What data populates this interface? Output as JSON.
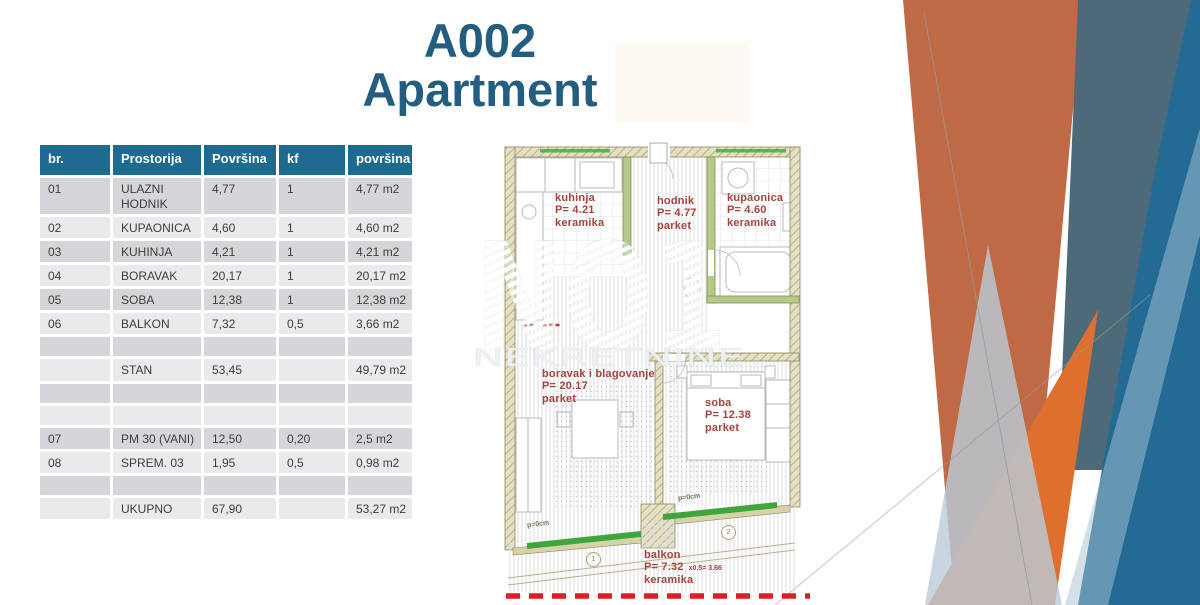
{
  "title": {
    "line1": "A002",
    "line2": "Apartment"
  },
  "table": {
    "headers": [
      "br.",
      "Prostorija",
      "Površina",
      "kf",
      "površina"
    ],
    "rows": [
      {
        "cells": [
          "01",
          "ULAZNI HODNIK",
          "4,77",
          "1",
          "4,77 m2"
        ]
      },
      {
        "cells": [
          "02",
          "KUPAONICA",
          "4,60",
          "1",
          "4,60 m2"
        ]
      },
      {
        "cells": [
          "03",
          "KUHINJA",
          "4,21",
          "1",
          "4,21 m2"
        ]
      },
      {
        "cells": [
          "04",
          "BORAVAK",
          "20,17",
          "1",
          "20,17 m2"
        ]
      },
      {
        "cells": [
          "05",
          "SOBA",
          "12,38",
          "1",
          "12,38 m2"
        ]
      },
      {
        "cells": [
          "06",
          "BALKON",
          "7,32",
          "0,5",
          "3,66 m2"
        ]
      },
      {
        "cells": [
          "",
          "",
          "",
          "",
          ""
        ]
      },
      {
        "cells": [
          "",
          "STAN",
          "53,45",
          "",
          "49,79 m2"
        ]
      },
      {
        "cells": [
          "",
          "",
          "",
          "",
          ""
        ]
      },
      {
        "cells": [
          "",
          "",
          "",
          "",
          ""
        ]
      },
      {
        "cells": [
          "07",
          "PM 30 (VANI)",
          "12,50",
          "0,20",
          "2,5 m2"
        ]
      },
      {
        "cells": [
          "08",
          "SPREM. 03",
          "1,95",
          "0,5",
          "0,98 m2"
        ]
      },
      {
        "cells": [
          "",
          "",
          "",
          "",
          ""
        ]
      },
      {
        "cells": [
          "",
          "UKUPNO",
          "67,90",
          "",
          "53,27 m2"
        ]
      }
    ]
  },
  "plan": {
    "watermark": {
      "line1": "NO1",
      "line2": "NEKRETNINE"
    },
    "rooms": [
      {
        "id": "kuhinja",
        "name": "kuhinja",
        "area": "P= 4.21",
        "floor": "keramika"
      },
      {
        "id": "hodnik",
        "name": "hodnik",
        "area": "P= 4.77",
        "floor": "parket"
      },
      {
        "id": "kupaonica",
        "name": "kupaonica",
        "area": "P= 4.60",
        "floor": "keramika"
      },
      {
        "id": "boravak",
        "name": "boravak i blagovanje",
        "area": "P= 20.17",
        "floor": "parket"
      },
      {
        "id": "soba",
        "name": "soba",
        "area": "P= 12.38",
        "floor": "parket"
      },
      {
        "id": "balkon",
        "name": "balkon",
        "area": "P= 7.32",
        "area_extra": "x0.5=  3.66",
        "floor": "keramika"
      }
    ],
    "annotations": {
      "slope_left": "p=0cm",
      "slope_right": "p=0cm",
      "door_tag_1": "1",
      "door_tag_2": "2"
    }
  },
  "colors": {
    "title_blue": "#235e80",
    "table_header_teal": "#1e6a90",
    "row_dark": "#d5d6d9",
    "row_light": "#e9eaec",
    "plan_label_red": "#a3453c",
    "boundary_dash_red": "#e11b23",
    "balcony_door_green": "#3fa63b",
    "deco_orange": "#c06a45",
    "deco_orange_bright": "#de6f2d",
    "deco_slate": "#4e6a78",
    "deco_blue": "#236b94",
    "deco_light_blue": "#b9ccd8"
  }
}
